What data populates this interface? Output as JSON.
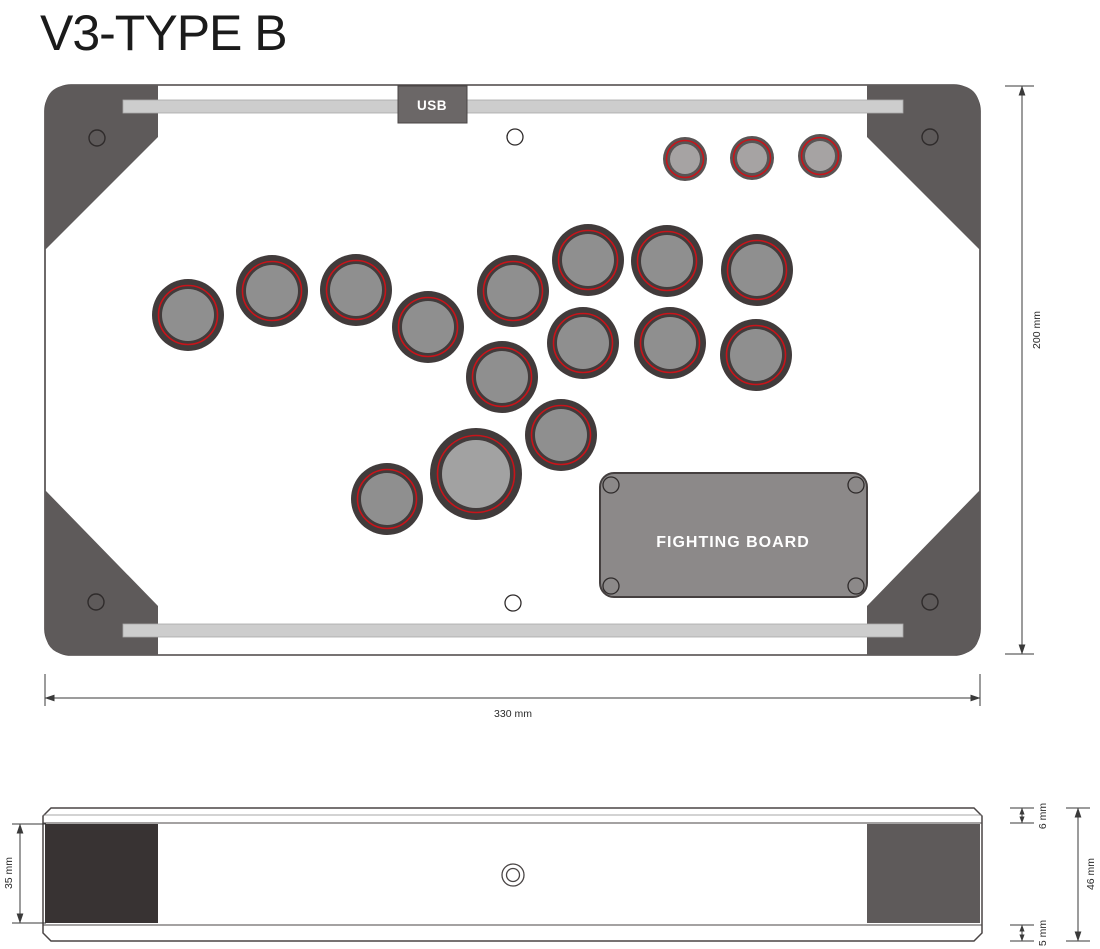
{
  "title": "V3-TYPE B",
  "top_view": {
    "usb_label": "USB",
    "board_label": "FIGHTING BOARD",
    "dims": {
      "width": "330 mm",
      "height": "200 mm"
    }
  },
  "side_view": {
    "dims": {
      "inner_height": "35 mm",
      "top_panel": "6 mm",
      "total_height": "46 mm",
      "bottom_panel": "5 mm"
    }
  },
  "colors": {
    "accent_red": "#c8141a",
    "corner_bracket": "#5e5a5a",
    "bar_gray": "#cdcdcd",
    "board_gray": "#8c8989",
    "usb_box": "#6b6767",
    "outline": "#4a4545",
    "side_left_block": "#383333",
    "side_right_block": "#5e5a5a",
    "dim_line": "#3a3a3a"
  },
  "buttons": {
    "styles": {
      "small": {
        "r_outer": 22,
        "r_red": 18.5,
        "r_inner": 15,
        "ring": "#585454",
        "red": "#c8141a",
        "inner": "#a6a3a3"
      },
      "regular": {
        "r_outer": 36,
        "r_red": 29.5,
        "r_inner": 26,
        "ring": "#413b3b",
        "red": "#c8141a",
        "inner": "#8f8f8f"
      },
      "big": {
        "r_outer": 46,
        "r_red": 38.5,
        "r_inner": 34,
        "ring": "#413b3b",
        "red": "#c8141a",
        "inner": "#a2a2a2"
      }
    },
    "positions": [
      {
        "kind": "small",
        "cx": 685,
        "cy": 159
      },
      {
        "kind": "small",
        "cx": 752,
        "cy": 158
      },
      {
        "kind": "small",
        "cx": 820,
        "cy": 156
      },
      {
        "kind": "regular",
        "cx": 188,
        "cy": 315
      },
      {
        "kind": "regular",
        "cx": 272,
        "cy": 291
      },
      {
        "kind": "regular",
        "cx": 356,
        "cy": 290
      },
      {
        "kind": "regular",
        "cx": 428,
        "cy": 327
      },
      {
        "kind": "regular",
        "cx": 513,
        "cy": 291
      },
      {
        "kind": "regular",
        "cx": 588,
        "cy": 260
      },
      {
        "kind": "regular",
        "cx": 667,
        "cy": 261
      },
      {
        "kind": "regular",
        "cx": 757,
        "cy": 270
      },
      {
        "kind": "regular",
        "cx": 502,
        "cy": 377
      },
      {
        "kind": "regular",
        "cx": 583,
        "cy": 343
      },
      {
        "kind": "regular",
        "cx": 670,
        "cy": 343
      },
      {
        "kind": "regular",
        "cx": 756,
        "cy": 355
      },
      {
        "kind": "regular",
        "cx": 561,
        "cy": 435
      },
      {
        "kind": "regular",
        "cx": 387,
        "cy": 499
      },
      {
        "kind": "big",
        "cx": 476,
        "cy": 474
      }
    ]
  }
}
